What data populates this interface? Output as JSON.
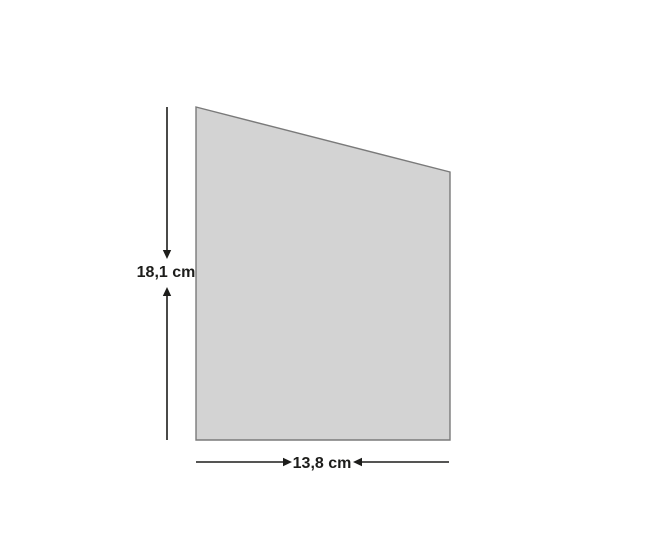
{
  "figure": {
    "shape": "right trapezoid",
    "unit": "cm",
    "height_label": "18,1 cm",
    "width_label": "13,8 cm",
    "height_cm": 18.1,
    "width_cm": 13.8,
    "colors": {
      "background": "#ffffff",
      "shape_fill": "#d3d3d3",
      "shape_stroke": "#7a7a7a",
      "dimension": "#1d1d1b"
    }
  }
}
